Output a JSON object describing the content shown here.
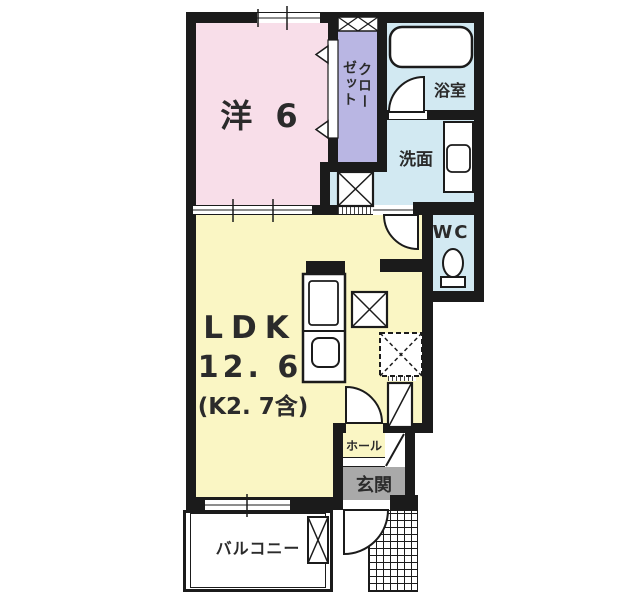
{
  "plan_title": "1LDK apartment floor plan",
  "rooms": {
    "western": {
      "label": "洋 6"
    },
    "closet": {
      "label": "クローゼット",
      "line1": "クロー",
      "line2": "ゼット"
    },
    "bath": {
      "label": "浴室"
    },
    "washroom": {
      "label": "洗面"
    },
    "wc": {
      "label": "WC"
    },
    "ldk": {
      "label": "LDK",
      "area": "12. 6",
      "note": "(K2. 7含)"
    },
    "hall": {
      "label": "ホール"
    },
    "entrance": {
      "label": "玄関"
    },
    "balcony": {
      "label": "バルコニー"
    }
  },
  "colors": {
    "wall": "#1b1b1b",
    "western": "#f8dee9",
    "closet": "#b9b6e3",
    "wet": "#d2e9f2",
    "ldk": "#faf6c4",
    "entrance": "#a9a9a9",
    "text": "#2b2b2b"
  }
}
